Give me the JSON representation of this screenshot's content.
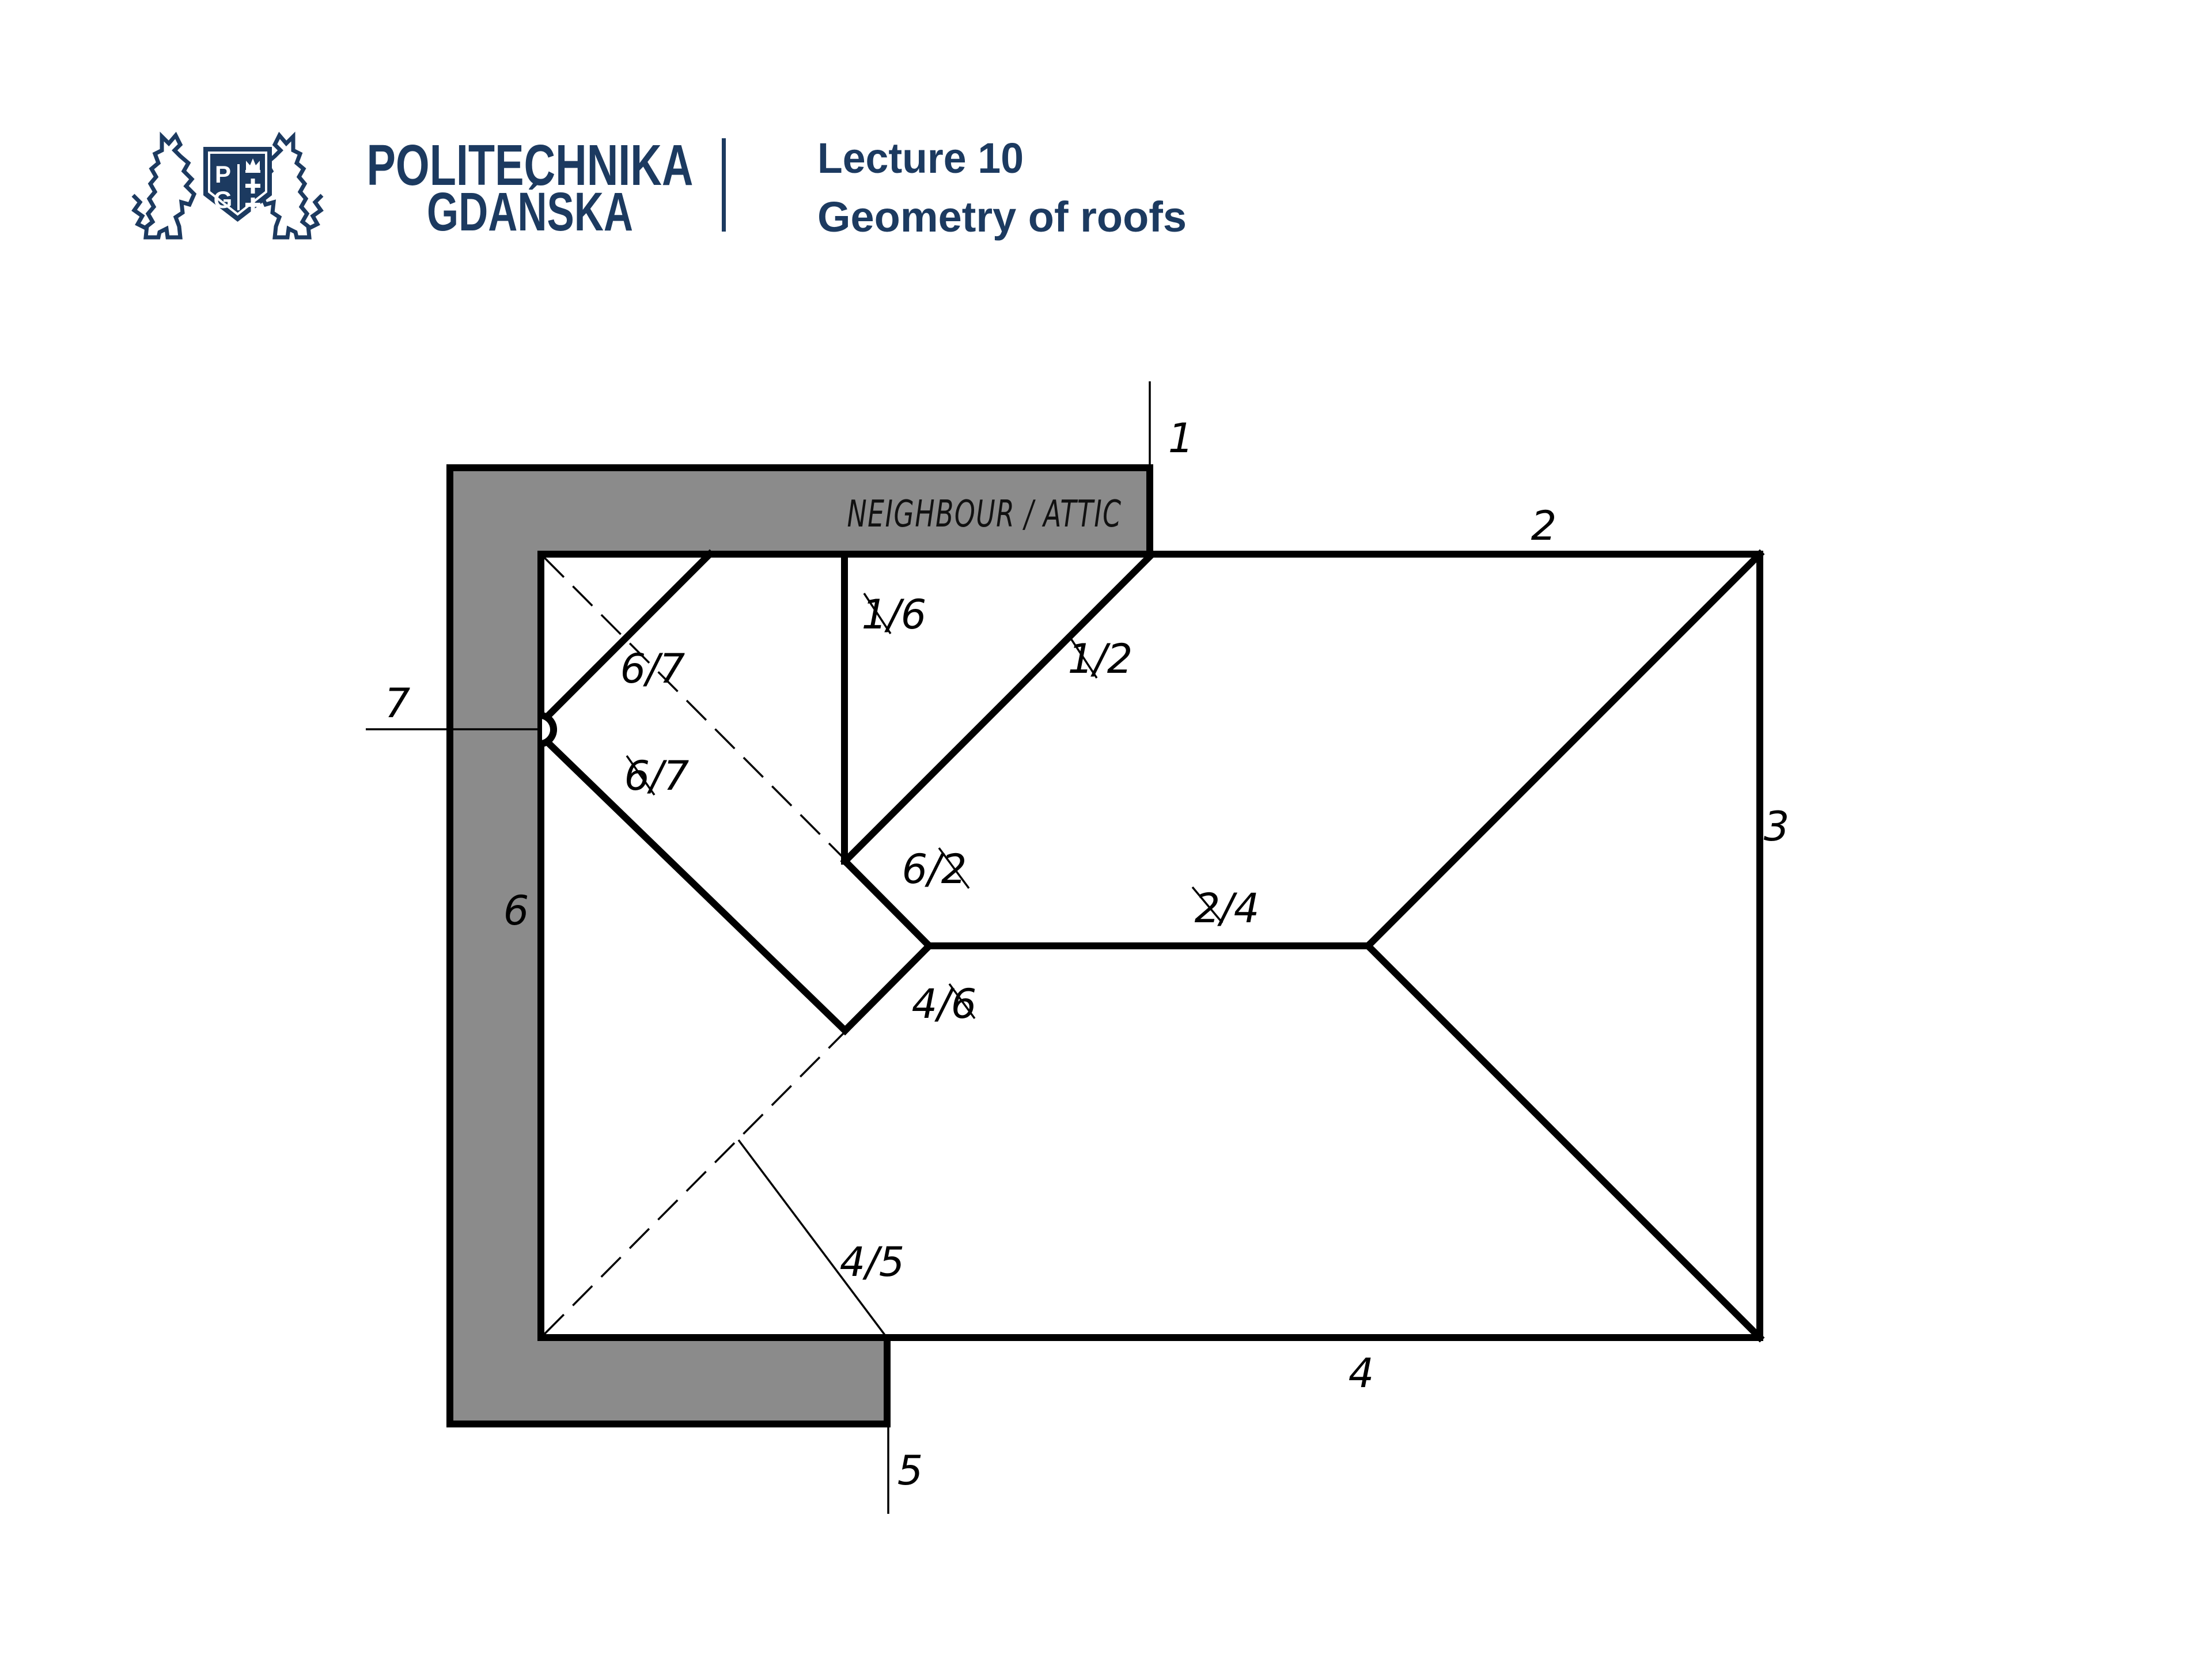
{
  "slide": {
    "header": {
      "brand_line1": "POLITECHNIKA",
      "brand_line2": "GDAŃSKA",
      "shield_letter_p": "P",
      "shield_letter_g": "G",
      "lecture_title": "Lecture 10",
      "lecture_subtitle": "Geometry of roofs"
    },
    "diagram": {
      "neighbour_label": "NEIGHBOUR / ATTIC",
      "edges": {
        "e1": "1",
        "e2": "2",
        "e3": "3",
        "e4": "4",
        "e5": "5",
        "e6": "6",
        "e7": "7"
      },
      "joints": {
        "j16": "1/6",
        "j12": "1/2",
        "j67_upper": "6/7",
        "j67_lower": "6/7",
        "j62": "6/2",
        "j24": "2/4",
        "j46": "4/6",
        "j45": "4/5"
      }
    },
    "colors": {
      "brand_navy": "#1c3a60",
      "wall_gray": "#8b8b8b",
      "line": "#000000",
      "background": "#ffffff"
    }
  }
}
